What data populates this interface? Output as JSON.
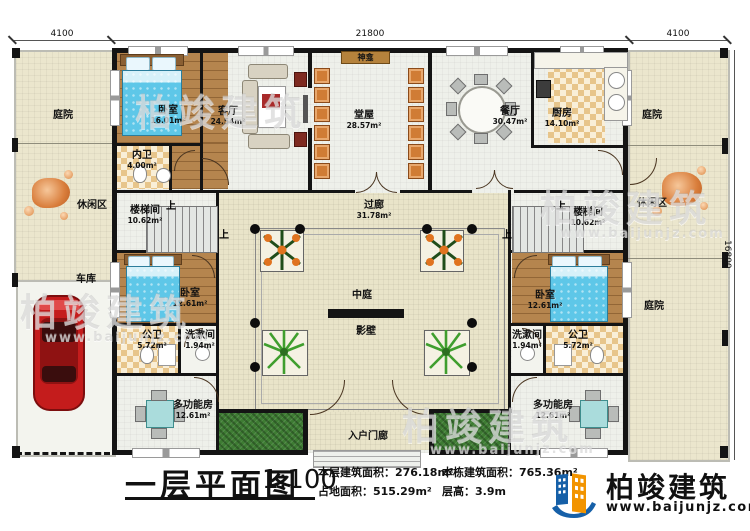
{
  "dim": {
    "top_left": "4100",
    "top_mid": "21800",
    "top_right": "4100",
    "right_side": "16800"
  },
  "labels": {
    "up": "上"
  },
  "rooms": {
    "courtyard_tl": {
      "name": "庭院"
    },
    "leisure_left": {
      "name": "休闲区"
    },
    "garage": {
      "name": "车库"
    },
    "bedroom_tl": {
      "name": "卧室",
      "area": "16.01m²"
    },
    "inner_bath": {
      "name": "内卫",
      "area": "4.00m²"
    },
    "living": {
      "name": "客厅",
      "area": "24.54m²"
    },
    "hall": {
      "name": "堂屋",
      "area": "28.57m²"
    },
    "shrine": {
      "name": "神龛"
    },
    "dining": {
      "name": "餐厅",
      "area": "30.47m²"
    },
    "kitchen": {
      "name": "厨房",
      "area": "14.10m²"
    },
    "courtyard_tr": {
      "name": "庭院"
    },
    "leisure_right": {
      "name": "休闲区"
    },
    "stair_left": {
      "name": "楼梯间",
      "area": "10.62m²"
    },
    "stair_right": {
      "name": "楼梯间",
      "area": "10.62m²"
    },
    "corridor": {
      "name": "过廊",
      "area": "31.78m²"
    },
    "atrium": {
      "name": "中庭"
    },
    "screen_wall": {
      "name": "影壁"
    },
    "bedroom_bl": {
      "name": "卧室",
      "area": "12.61m²"
    },
    "public_bath_left": {
      "name": "公卫",
      "area": "5.72m²"
    },
    "wash_left": {
      "name": "洗漱间",
      "area": "1.94m²"
    },
    "multi_left": {
      "name": "多功能房",
      "area": "12.61m²"
    },
    "bedroom_br": {
      "name": "卧室",
      "area": "12.61m²"
    },
    "wash_right": {
      "name": "洗漱间",
      "area": "1.94m²"
    },
    "public_bath_right": {
      "name": "公卫",
      "area": "5.72m²"
    },
    "multi_right": {
      "name": "多功能房",
      "area": "12.61m²"
    },
    "courtyard_br": {
      "name": "庭院"
    },
    "entry_porch": {
      "name": "入户门廊"
    }
  },
  "footer": {
    "title": "一层平面图",
    "scale": "1:100",
    "stats": [
      {
        "label": "本层建筑面积：",
        "value": "276.18m²"
      },
      {
        "label": "占地面积：",
        "value": "515.29m²"
      },
      {
        "label": "本栋建筑面积：",
        "value": "765.36m²"
      },
      {
        "label": "层高：",
        "value": "3.9m"
      }
    ]
  },
  "brand": {
    "name": "柏竣建筑",
    "website": "www.baijunjz.com"
  },
  "watermark": {
    "text": "柏竣建筑",
    "website": "www.baijunjz.com"
  },
  "colors": {
    "wall": "#141414",
    "site_beige": "#ebe6cd",
    "wood_floor": "#b5854e",
    "bed_blue": "#5ec7e8",
    "chair_orange": "#d07c35",
    "grass_green": "#3e7c33",
    "logo_blue": "#1660a8",
    "logo_orange": "#f29400",
    "car_red": "#c41c1c"
  }
}
